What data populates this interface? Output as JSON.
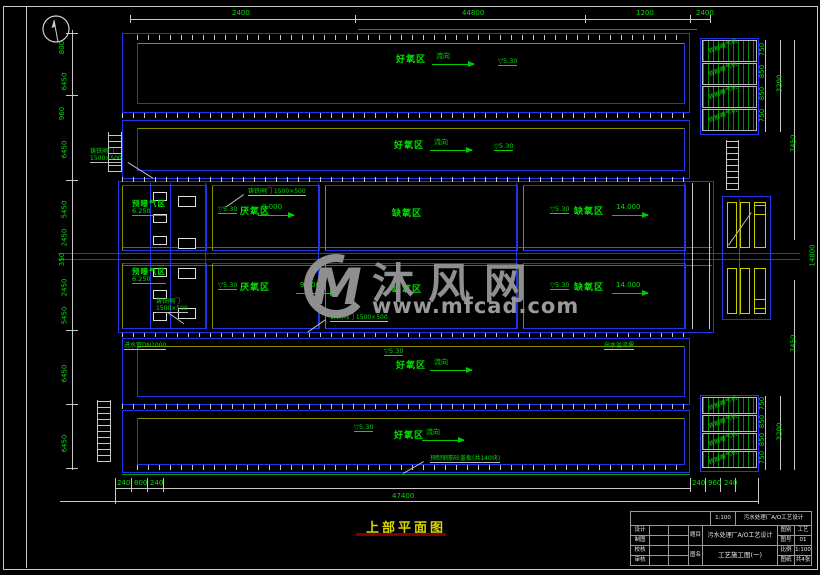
{
  "watermark": {
    "logo_text": "M",
    "site_name": "沐风网",
    "site_url": "www.mfcad.com"
  },
  "title": {
    "text": "上部平面图"
  },
  "zones": {
    "basin_top": "好氧区",
    "basin_second": "好氧区",
    "basin_third": "好氧区",
    "basin_bottom": "好氧区",
    "row1": {
      "c1": "预曝气区",
      "c1_sub": "6.250",
      "c2": "厌氧区",
      "c3": "缺氧区",
      "c4": "缺氧区"
    },
    "row2": {
      "c1": "预曝气区",
      "c1_sub": "6.250",
      "c2": "厌氧区",
      "c3": "缺氧区",
      "c4": "缺氧区"
    }
  },
  "flow": {
    "basin": "流向",
    "c2": "9.000",
    "c4": "14.000"
  },
  "elevation": "▽5.30",
  "equipment": {
    "aerator": "转刷曝气机"
  },
  "leaders": {
    "gate1": "铸铁闸门\n1500×500",
    "gate2": "铸铁闸门 1500×500",
    "gate3": "铸铁闸门\n1500×500",
    "gate4": "铸铁闸门 1500×500",
    "cover": "预制钢筋砼盖板(共140块)",
    "inlet": "进水管DN1000",
    "outlet": "出水溢流堰"
  },
  "dims": {
    "top": [
      "2400",
      "44800",
      "1200",
      "2400"
    ],
    "left": [
      "800",
      "6450",
      "960",
      "6450",
      "5450",
      "2450",
      "350",
      "2450",
      "5450",
      "6450",
      "6450"
    ],
    "right_top": [
      "750",
      "850",
      "850",
      "750",
      "3200",
      "7450"
    ],
    "right_bottom": [
      "750",
      "850",
      "850",
      "750",
      "3200",
      "7450"
    ],
    "right_overall": "14800",
    "bottom_left": [
      "240",
      "800",
      "240"
    ],
    "bottom_right": [
      "240",
      "960",
      "240"
    ],
    "bottom_overall": "47400"
  },
  "titleblock": {
    "scale_cell": "1:100",
    "school": "污水处理厂A/O工艺设计",
    "rows_left": [
      "设计",
      "制图",
      "校核",
      "审核"
    ],
    "project_label": "题目",
    "project": "污水处理厂A/O工艺设计",
    "drawing_label": "图名",
    "drawing": "工艺施工图(一)",
    "rows_right": [
      [
        "图别",
        "工艺"
      ],
      [
        "图号",
        "01"
      ],
      [
        "比例",
        "1:100"
      ],
      [
        "图纸",
        "共4张"
      ]
    ]
  }
}
